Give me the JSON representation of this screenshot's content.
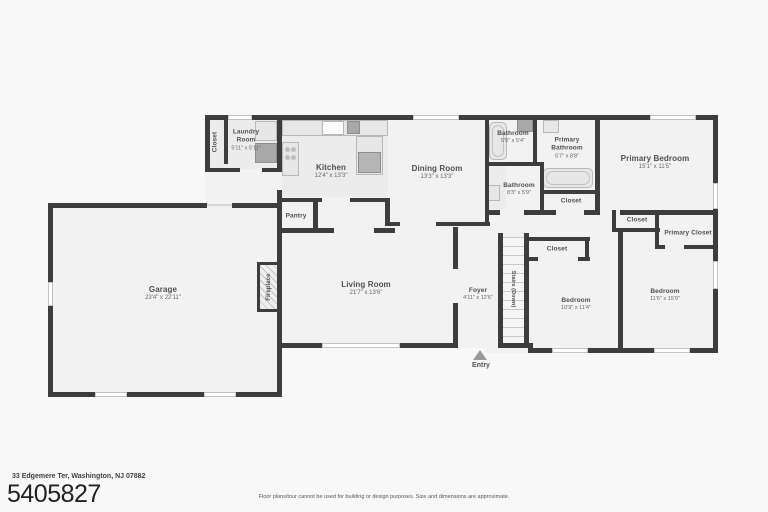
{
  "colors": {
    "wall": "#3d3d3d",
    "room_fill": "#f2f2f2",
    "background": "#f8f8f8",
    "text": "#4f4f4f"
  },
  "floorplan": {
    "entry_label": "Entry",
    "rooms": [
      {
        "id": "garage",
        "name": "Garage",
        "dims": "23'4\" x 22'11\""
      },
      {
        "id": "living-room",
        "name": "Living Room",
        "dims": "21'7\" x 13'6\""
      },
      {
        "id": "kitchen",
        "name": "Kitchen",
        "dims": "12'4\" x 13'3\""
      },
      {
        "id": "dining-room",
        "name": "Dining Room",
        "dims": "13'3\" x 13'3\""
      },
      {
        "id": "laundry-room",
        "name": "Laundry Room",
        "dims": "5'11\" x 5'11\""
      },
      {
        "id": "foyer",
        "name": "Foyer",
        "dims": "4'11\" x 12'6\""
      },
      {
        "id": "bathroom-top",
        "name": "Bathroom",
        "dims": "5'5\" x 5'4\""
      },
      {
        "id": "primary-bathroom",
        "name": "Primary Bathroom",
        "dims": "5'7\" x 8'8\""
      },
      {
        "id": "bathroom-hall",
        "name": "Bathroom",
        "dims": "8'3\" x 5'9\""
      },
      {
        "id": "primary-bedroom",
        "name": "Primary Bedroom",
        "dims": "15'1\" x 11'5\""
      },
      {
        "id": "bedroom-left",
        "name": "Bedroom",
        "dims": "10'9\" x 11'4\""
      },
      {
        "id": "bedroom-right",
        "name": "Bedroom",
        "dims": "11'6\" x 15'9\""
      },
      {
        "id": "closet-laundry",
        "name": "Closet",
        "dims": ""
      },
      {
        "id": "pantry",
        "name": "Pantry",
        "dims": ""
      },
      {
        "id": "fireplace",
        "name": "Fireplace",
        "dims": ""
      },
      {
        "id": "stairs",
        "name": "Stairs (Down)",
        "dims": ""
      },
      {
        "id": "closet-hall",
        "name": "Closet",
        "dims": ""
      },
      {
        "id": "closet-bedroom-left",
        "name": "Closet",
        "dims": ""
      },
      {
        "id": "closet-strip",
        "name": "Closet",
        "dims": ""
      },
      {
        "id": "primary-closet",
        "name": "Primary Closet",
        "dims": ""
      }
    ]
  },
  "footer": {
    "address": "33 Edgemere Ter, Washington, NJ 07882",
    "mls_number": "5405827",
    "disclaimer": "Floor plans/tour cannot be used for building or design purposes. Size and dimensions are approximate."
  }
}
